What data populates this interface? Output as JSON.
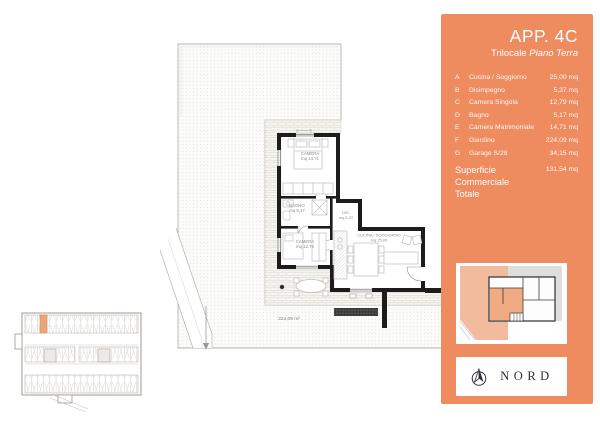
{
  "sidebar": {
    "title": "APP. 4C",
    "subtitle": {
      "prefix": "Trilocale ",
      "italic": "Piano Terra"
    },
    "rooms": [
      {
        "letter": "A",
        "name": "Cucina / Soggiorno",
        "area": "25,00 mq"
      },
      {
        "letter": "B",
        "name": "Disimpegno",
        "area": "5,37 mq"
      },
      {
        "letter": "C",
        "name": "Camera Singola",
        "area": "12,79 mq"
      },
      {
        "letter": "D",
        "name": "Bagno",
        "area": "5,17 mq"
      },
      {
        "letter": "E",
        "name": "Camera Matrimoniale",
        "area": "14,71 mq"
      },
      {
        "letter": "F",
        "name": "Giardino",
        "area": "224,09 mq"
      },
      {
        "letter": "G",
        "name": "Garage S/28",
        "area": "34,15 mq"
      }
    ],
    "total": {
      "label_line1": "Superficie Commerciale",
      "label_line2": "Totale",
      "value": "131,54 mq"
    },
    "north": {
      "label": "NORD"
    }
  },
  "plan": {
    "labels": {
      "camera_matrimoniale": [
        "CAMERA",
        "mq 14,71"
      ],
      "bagno": [
        "BAGNO",
        "mq 5,17"
      ],
      "camera_singola": [
        "CAMERA",
        "mq 12,79"
      ],
      "disimpegno": [
        "DIS.",
        "mq 5,37"
      ],
      "cucina_soggiorno": [
        "CUCINA / SOGGIORNO",
        "mq 25,00"
      ],
      "giardino_area": "224,09 m²"
    }
  },
  "colors": {
    "sidebar_orange": "#ee8b5f",
    "map_highlight_salmon": "#f2bb9e",
    "map_unit_salmon": "#f0aa84",
    "garage_stall_orange": "#efa379",
    "wall_black": "#1c1c1c",
    "nord_text": "#2e2e38"
  }
}
